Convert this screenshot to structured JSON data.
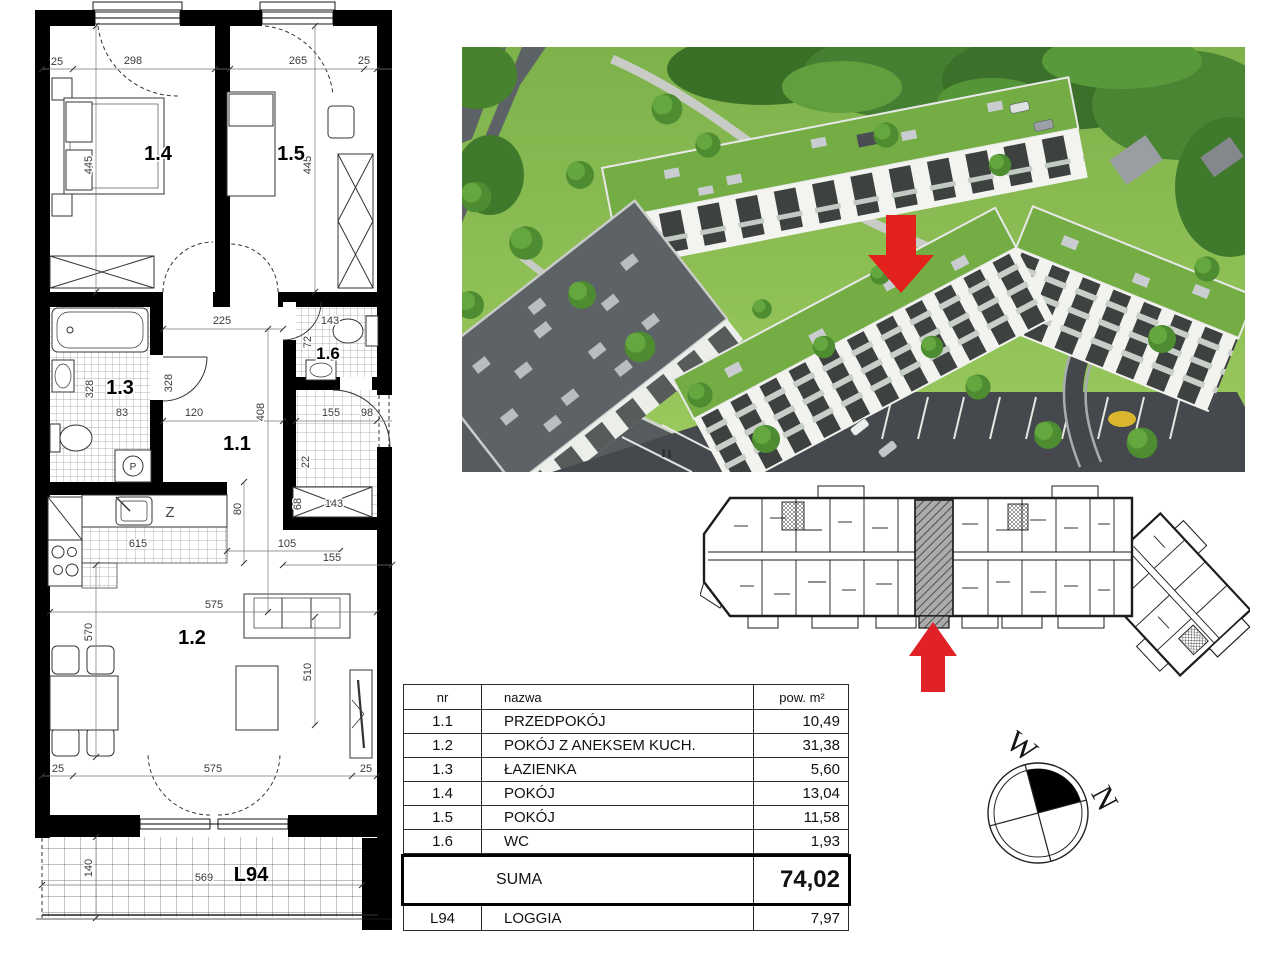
{
  "plan": {
    "rooms": {
      "r14": "1.4",
      "r15": "1.5",
      "r13": "1.3",
      "r11": "1.1",
      "r16": "1.6",
      "r12": "1.2",
      "loggia": "L94",
      "dishwasher": "Z",
      "washer": "P"
    },
    "dims": [
      "25",
      "298",
      "265",
      "25",
      "445",
      "445",
      "225",
      "328",
      "328",
      "83",
      "120",
      "408",
      "143",
      "72",
      "155",
      "98",
      "22",
      "68",
      "143",
      "80",
      "615",
      "105",
      "155",
      "575",
      "570",
      "510",
      "25",
      "575",
      "25",
      "140",
      "569"
    ]
  },
  "compass": {
    "west": "W",
    "north": "N"
  },
  "table": {
    "headers": [
      "nr",
      "nazwa",
      "pow. m²"
    ],
    "rows": [
      {
        "nr": "1.1",
        "name": "PRZEDPOKÓJ",
        "area": "10,49"
      },
      {
        "nr": "1.2",
        "name": "POKÓJ Z ANEKSEM KUCH.",
        "area": "31,38"
      },
      {
        "nr": "1.3",
        "name": "ŁAZIENKA",
        "area": "5,60"
      },
      {
        "nr": "1.4",
        "name": "POKÓJ",
        "area": "13,04"
      },
      {
        "nr": "1.5",
        "name": "POKÓJ",
        "area": "11,58"
      },
      {
        "nr": "1.6",
        "name": "WC",
        "area": "1,93"
      }
    ],
    "suma_label": "SUMA",
    "suma_value": "74,02",
    "loggia_row": {
      "nr": "L94",
      "name": "LOGGIA",
      "area": "7,97"
    }
  },
  "colors": {
    "arrow_red": "#e02127",
    "roof_green": "#74ad43",
    "grass": "#8cc152",
    "walls": "#000000"
  }
}
